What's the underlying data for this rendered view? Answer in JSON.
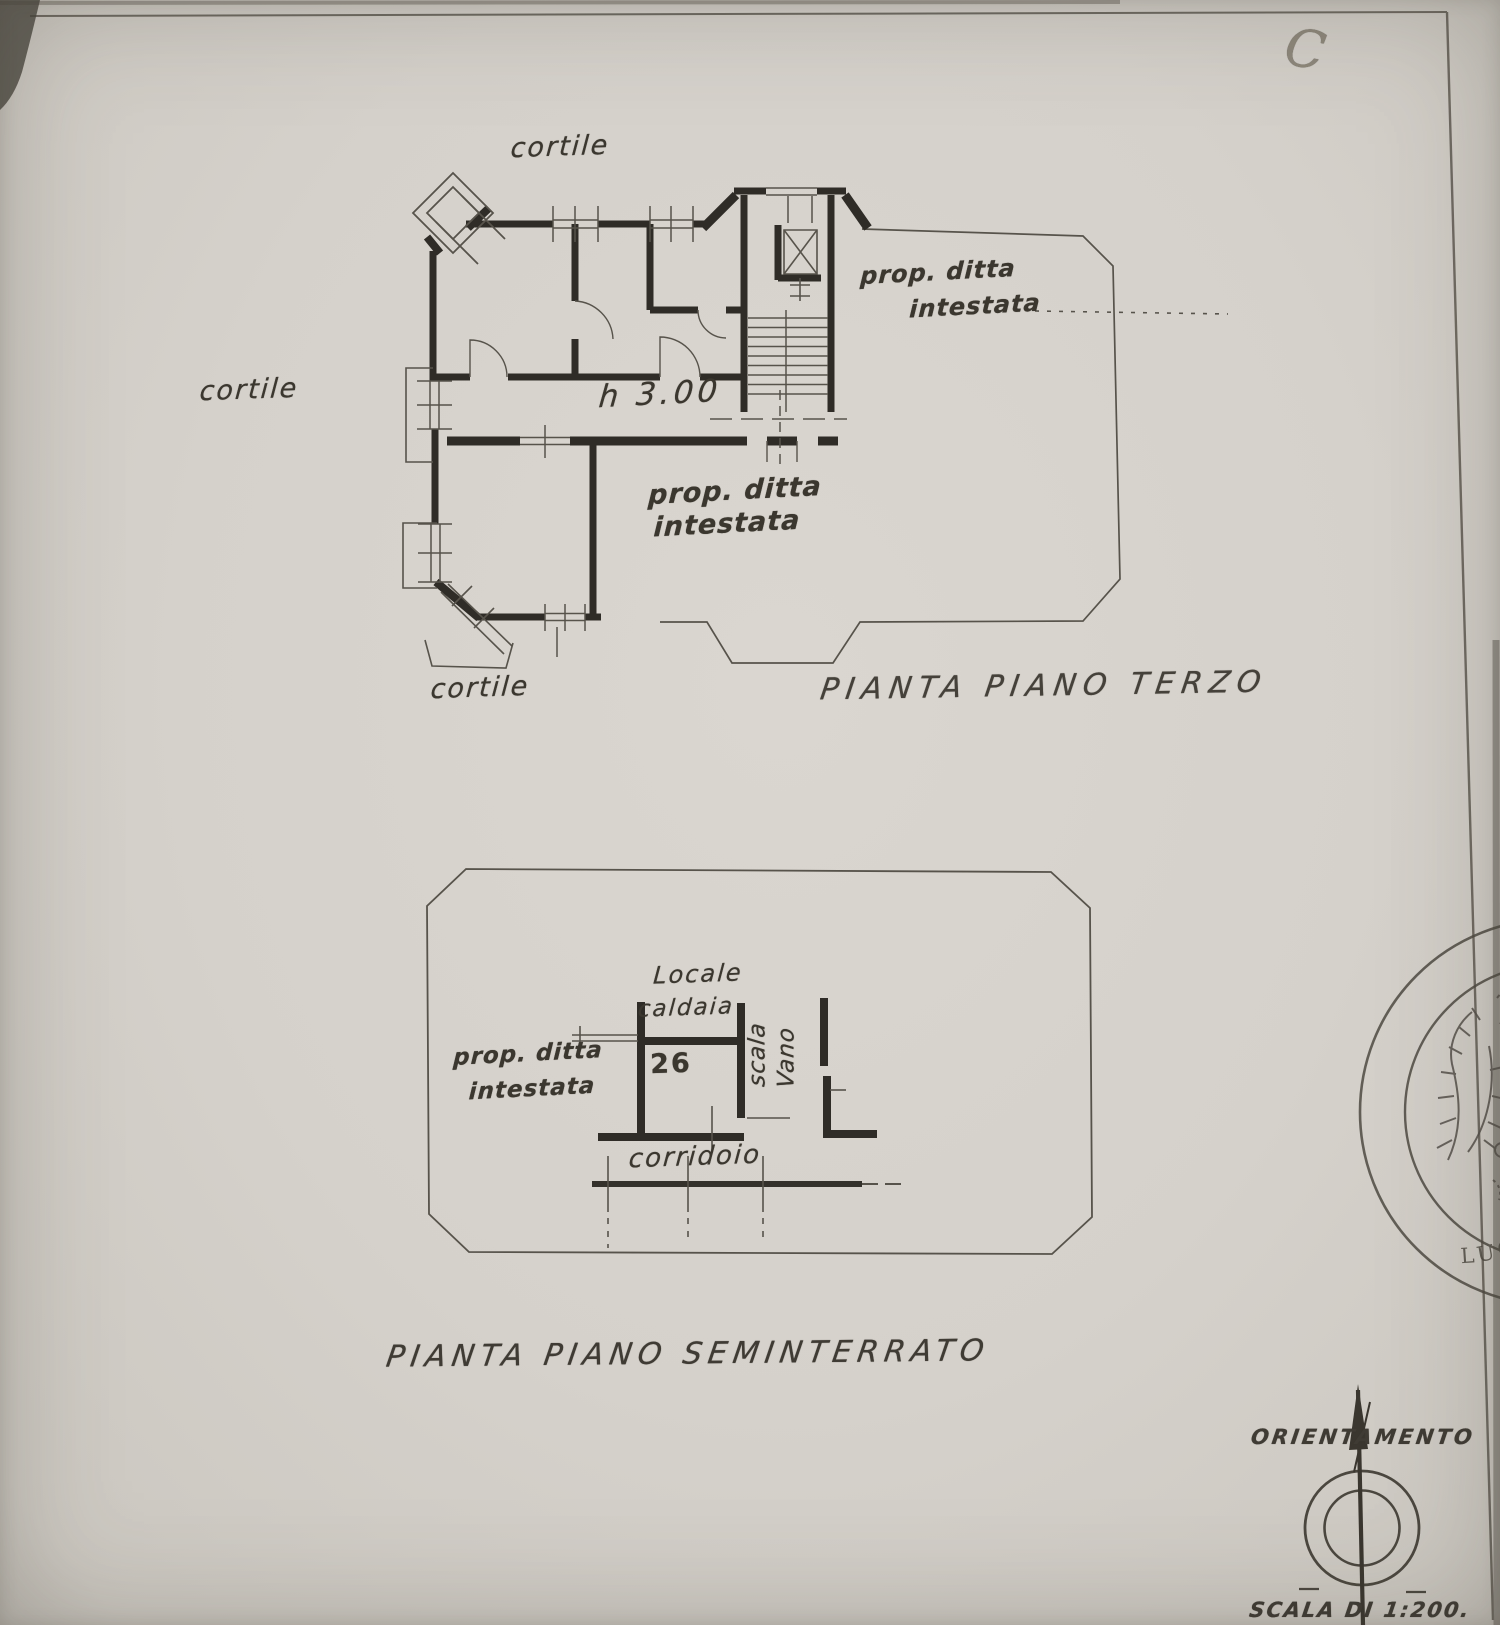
{
  "sheet": {
    "corner_mark": "C",
    "paper_color": "#d6d2cc",
    "ink_color": "#3a362f",
    "wall_color": "#2f2c27"
  },
  "third_floor_plan": {
    "caption": "PIANTA PIANO TERZO",
    "height_note": "h 3.00",
    "courtyard_labels": {
      "top": "cortile",
      "left": "cortile",
      "bottom": "cortile"
    },
    "neighbor_label_right": {
      "line1": "prop. ditta",
      "line2": "intestata"
    },
    "neighbor_label_middle": {
      "line1": "prop. ditta",
      "line2": "intestata"
    }
  },
  "basement_plan": {
    "caption": "PIANTA PIANO SEMINTERRATO",
    "boiler_room_label": {
      "line1": "Locale",
      "line2": "caldaia"
    },
    "room_number": "26",
    "neighbor_label": {
      "line1": "prop. ditta",
      "line2": "intestata"
    },
    "stair_shaft_label": {
      "line1": "Vano",
      "line2": "scala"
    },
    "corridor_label": "corridoio"
  },
  "footer": {
    "orientation_label": "ORIENTAMENTO",
    "scale_label": "SCALA DI 1:200."
  },
  "stamp": {
    "arc_text": "LUCA SAVERIO FELICE DI"
  }
}
